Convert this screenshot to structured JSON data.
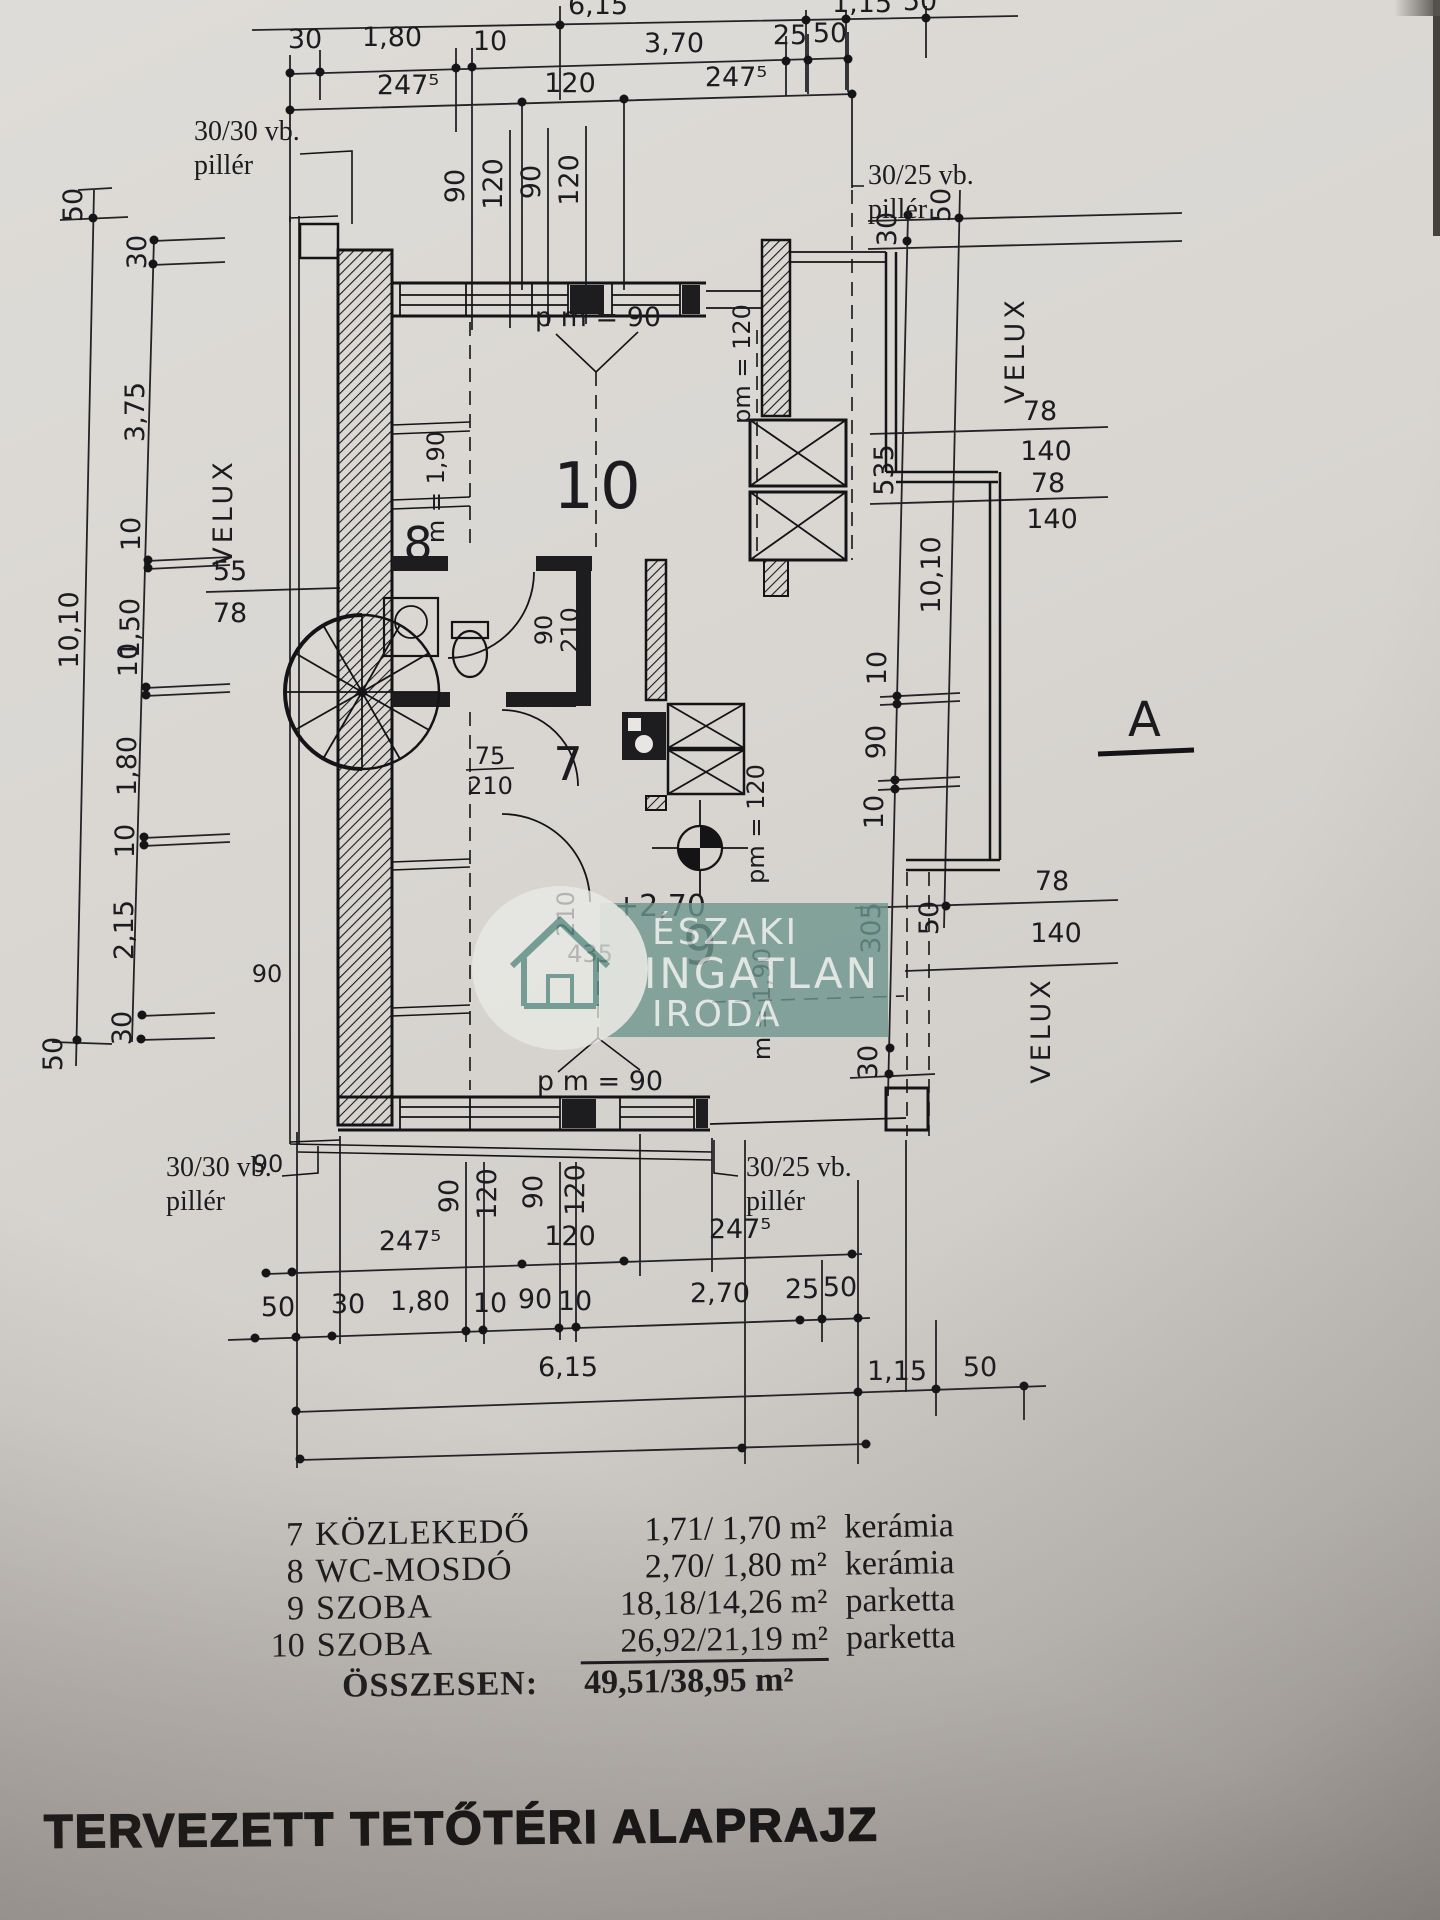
{
  "document": {
    "title": "TERVEZETT TETŐTÉRI ALAPRAJZ"
  },
  "section_marker": "A",
  "watermark": {
    "line1": "ÉSZAKI",
    "line2": "INGATLAN",
    "line3": "IRODA"
  },
  "legend": {
    "rows": [
      {
        "num": "7",
        "name": "KÖZLEKEDŐ",
        "value": "1,71/ 1,70 m²",
        "finish": "kerámia"
      },
      {
        "num": "8",
        "name": "WC-MOSDÓ",
        "value": "2,70/ 1,80 m²",
        "finish": "kerámia"
      },
      {
        "num": "9",
        "name": "SZOBA",
        "value": "18,18/14,26 m²",
        "finish": "parketta"
      },
      {
        "num": "10",
        "name": "SZOBA",
        "value": "26,92/21,19 m²",
        "finish": "parketta"
      }
    ],
    "total_label": "ÖSSZESEN:",
    "total_value": "49,51/38,95 m²"
  },
  "plan": {
    "rooms": {
      "r7": "7",
      "r8": "8",
      "r9": "9",
      "r10": "10"
    },
    "pillars": {
      "tl1": "30/30 vb.",
      "tl2": "pillér",
      "tr1": "30/25 vb.",
      "tr2": "pillér",
      "bl1": "30/30 vb.",
      "bl2": "pillér",
      "br1": "30/25 vb.",
      "br2": "pillér"
    },
    "velux": "VELUX",
    "ann": {
      "pm90": "p m = 90",
      "pm120": "pm = 120",
      "m190": "m = 1,90",
      "level": "+2,70",
      "d435": "435",
      "d210": "210",
      "d75": "75",
      "d90": "90",
      "w90": "90"
    },
    "dims": {
      "top0": [
        "6,15",
        "1,15",
        "50"
      ],
      "top1": [
        "30",
        "1,80",
        "10",
        "3,70",
        "25",
        "50"
      ],
      "top2": [
        "247⁵",
        "120",
        "247⁵"
      ],
      "cols": [
        "90",
        "120",
        "90",
        "120"
      ],
      "left_outer": [
        "50",
        "10,10",
        "50"
      ],
      "left_inner": [
        "30",
        "3,75",
        "10",
        "1,50",
        "10",
        "1,80",
        "10",
        "2,15",
        "30"
      ],
      "left_frac_a": "55",
      "left_frac_b": "78",
      "right_outer": [
        "50",
        "10,10",
        "50"
      ],
      "right_inner": [
        "30",
        "535",
        "10",
        "90",
        "10",
        "305",
        "30"
      ],
      "rv_top": [
        "78",
        "140",
        "78",
        "140"
      ],
      "rv_bot": [
        "78",
        "140"
      ],
      "bot1": [
        "247⁵",
        "120",
        "247⁵"
      ],
      "bot2": [
        "50",
        "30",
        "1,80",
        "10",
        "90",
        "10",
        "2,70",
        "25",
        "50"
      ],
      "bot3": [
        "6,15",
        "1,15",
        "50"
      ]
    }
  }
}
